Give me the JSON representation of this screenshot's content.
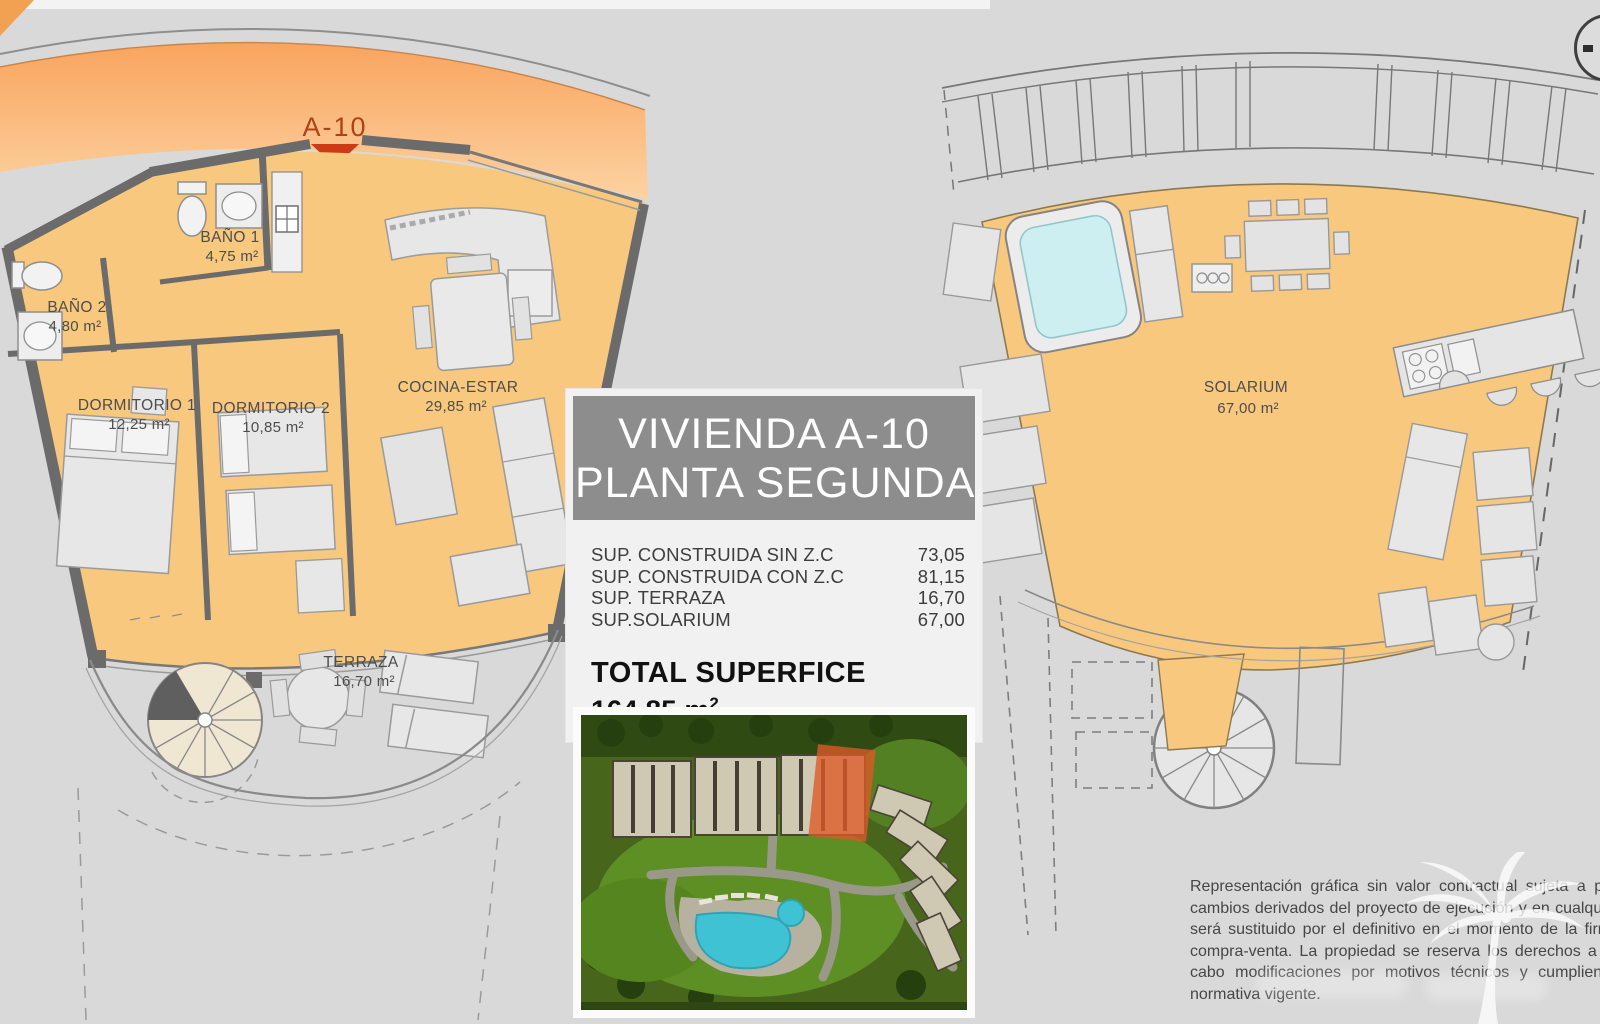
{
  "left_plan": {
    "unit_marker": "A-10",
    "rooms": [
      {
        "name": "BAÑO 1",
        "area": "4,75 m²"
      },
      {
        "name": "BAÑO 2",
        "area": "4,80 m²"
      },
      {
        "name": "DORMITORIO 1",
        "area": "12,25 m²"
      },
      {
        "name": "DORMITORIO 2",
        "area": "10,85 m²"
      },
      {
        "name": "COCINA-ESTAR",
        "area": "29,85 m²"
      },
      {
        "name": "TERRAZA",
        "area": "16,70 m²"
      }
    ]
  },
  "right_plan": {
    "room": {
      "name": "SOLARIUM",
      "area": "67,00 m²"
    }
  },
  "info_panel": {
    "title_line1": "VIVIENDA A-10",
    "title_line2": "PLANTA SEGUNDA",
    "surface_rows": [
      {
        "label": "SUP. CONSTRUIDA SIN Z.C",
        "value": "73,05"
      },
      {
        "label": "SUP. CONSTRUIDA CON Z.C",
        "value": "81,15"
      },
      {
        "label": "SUP. TERRAZA",
        "value": "16,70"
      },
      {
        "label": "SUP.SOLARIUM",
        "value": "67,00"
      }
    ],
    "total_label": "TOTAL SUPERFICE",
    "total_value": "164,85 m",
    "total_exponent": "2"
  },
  "disclaimer": {
    "lines": [
      "Representación gráfica sin valor contractual sujeta a pos",
      "cambios derivados del proyecto de ejecución y en cualquier",
      "será sustituido por el definitivo en el momento de la firma",
      "compra-venta. La propiedad se reserva los derechos a lle",
      "cabo modificaciones por motivos técnicos y cumpliendo",
      "normativa vigente."
    ]
  },
  "colors": {
    "page_bg": "#d9d9d9",
    "floor_orange": "#f7c87e",
    "band_orange_top": "#f9a45e",
    "band_orange_bottom": "#fcd3a2",
    "marker_red": "#c43a14",
    "wall_gray": "#6b6b6b",
    "title_box_gray": "#8d8d8d",
    "jacuzzi_blue": "#cdeff1",
    "pool_blue": "#3fc3d4",
    "highlight_orange": "#dd5a28"
  }
}
